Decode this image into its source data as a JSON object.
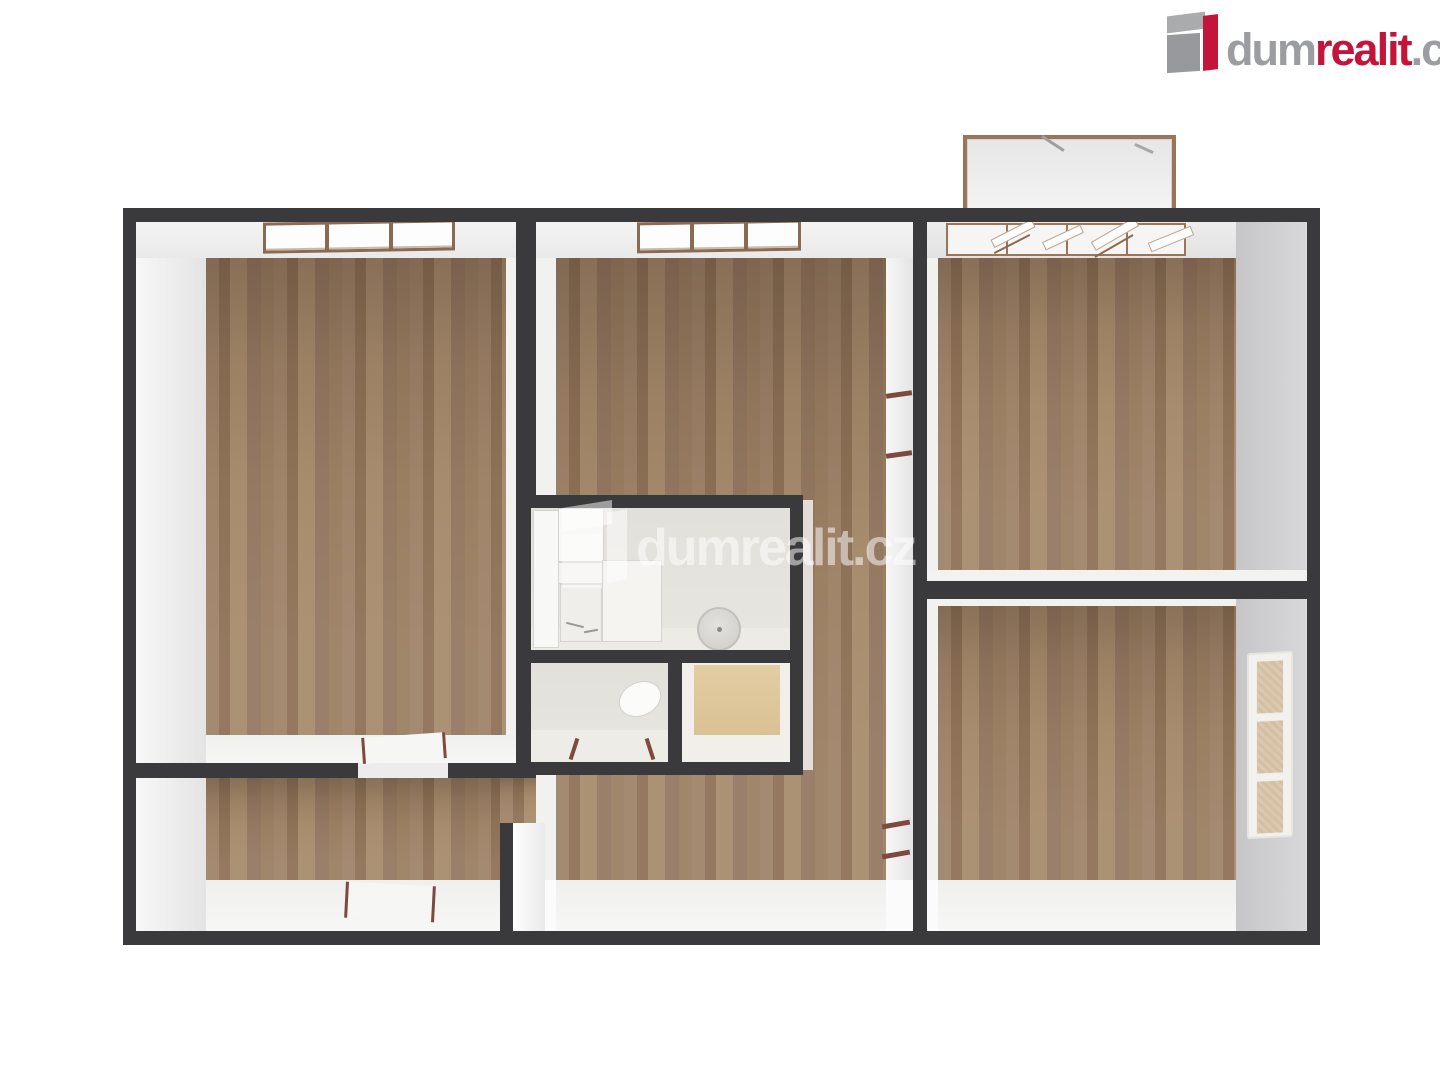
{
  "logo": {
    "text_dum": "dum",
    "text_realit": "realit",
    "text_cz": ".cz"
  },
  "watermark": {
    "text": "dumrealit.cz"
  },
  "colors": {
    "wall": "#3a3a3c",
    "wood": "#9a7e62",
    "beige_floor": "#dfc99e",
    "bath_tile": "#e3e1db",
    "logo_red": "#c3143a",
    "logo_gray": "#9b9da0",
    "window_frame": "#8a6b52",
    "door_mark": "#7d4a3d"
  }
}
